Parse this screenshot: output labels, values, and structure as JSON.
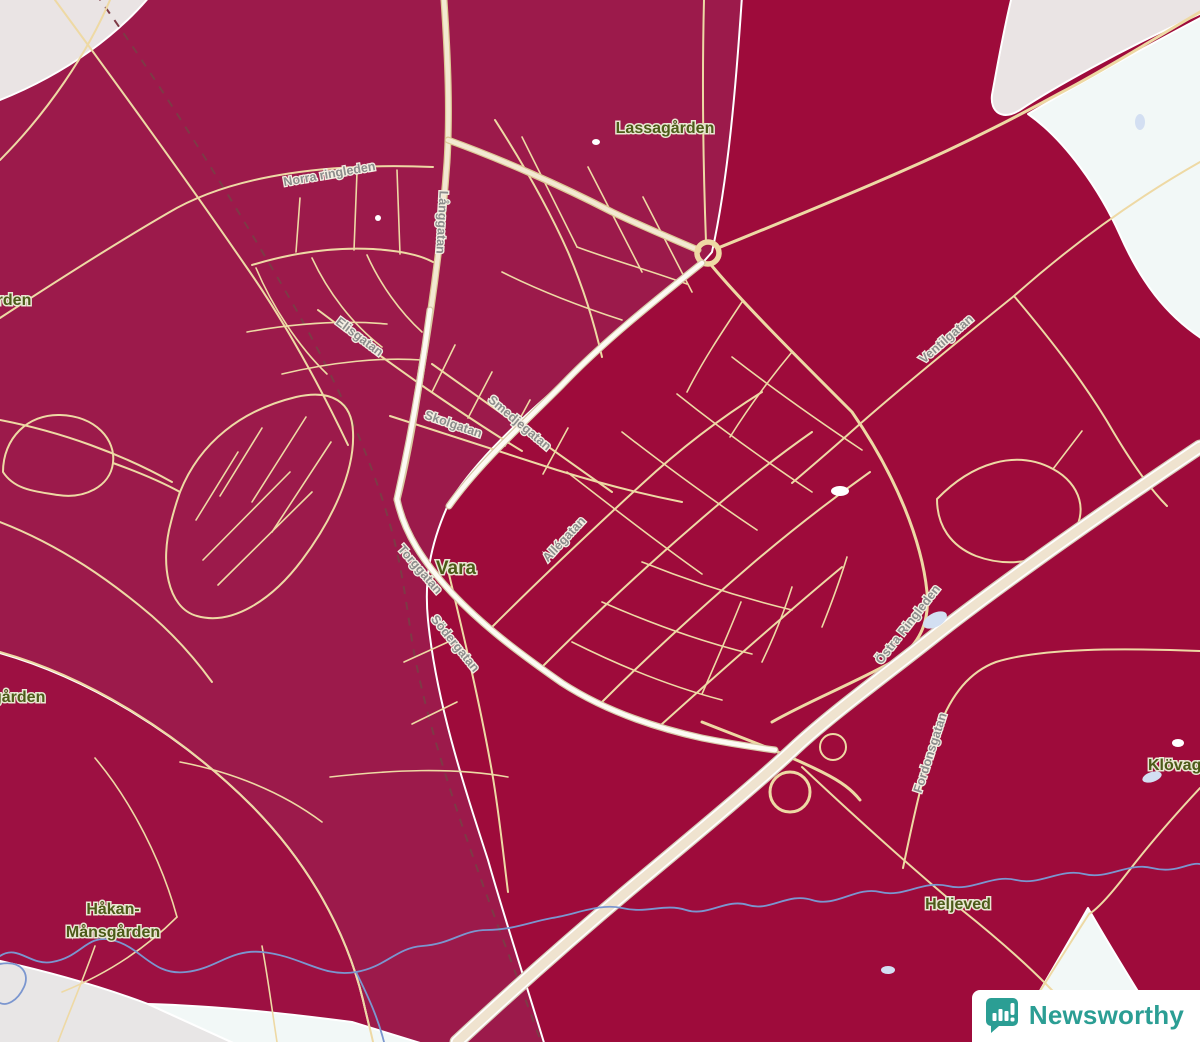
{
  "map": {
    "town_label": "Vara",
    "places": {
      "lassagarden": "Lassagården",
      "hakan_line1": "Håkan-",
      "hakan_line2": "Månsgården",
      "heljeved": "Heljeved",
      "klovagarden": "Klövagården",
      "left_upper_partial": "gården",
      "left_lower_partial": "gården"
    },
    "streets": {
      "norra_ringleden": "Norra ringleden",
      "langgatan": "Långgatan",
      "elisgatan": "Elisgatan",
      "skolgatan": "Skolgatan",
      "smedjegatan": "Smedjegatan",
      "allegatan": "Allégatan",
      "torggatan": "Torggatan",
      "sodergatan": "Södergatan",
      "ventilgatan": "Ventilgatan",
      "ostra_ringleden": "Östra Ringleden",
      "fordonsgatan": "Fordonsgatan"
    }
  },
  "logo": {
    "brand": "Newsworthy"
  },
  "colors": {
    "region_west": "#9c1a4b",
    "region_east": "#9e0b3b",
    "region_southwest": "#9d1042",
    "nodata_gray": "#eae4e4",
    "nodata_gray2": "#e8e6e6",
    "nodata_mint": "#f2f8f7",
    "road": "#eed9a4",
    "highway_fill": "#efe3cf",
    "white_road": "#fdfbf4",
    "railway": "#7d3a46",
    "water": "#7b96cf",
    "water_fill": "#d3dff2",
    "place_label": "#4c5a18",
    "street_label": "#8c8c8c",
    "brand_teal": "#2b9e94",
    "logo_bg": "#ffffff"
  }
}
